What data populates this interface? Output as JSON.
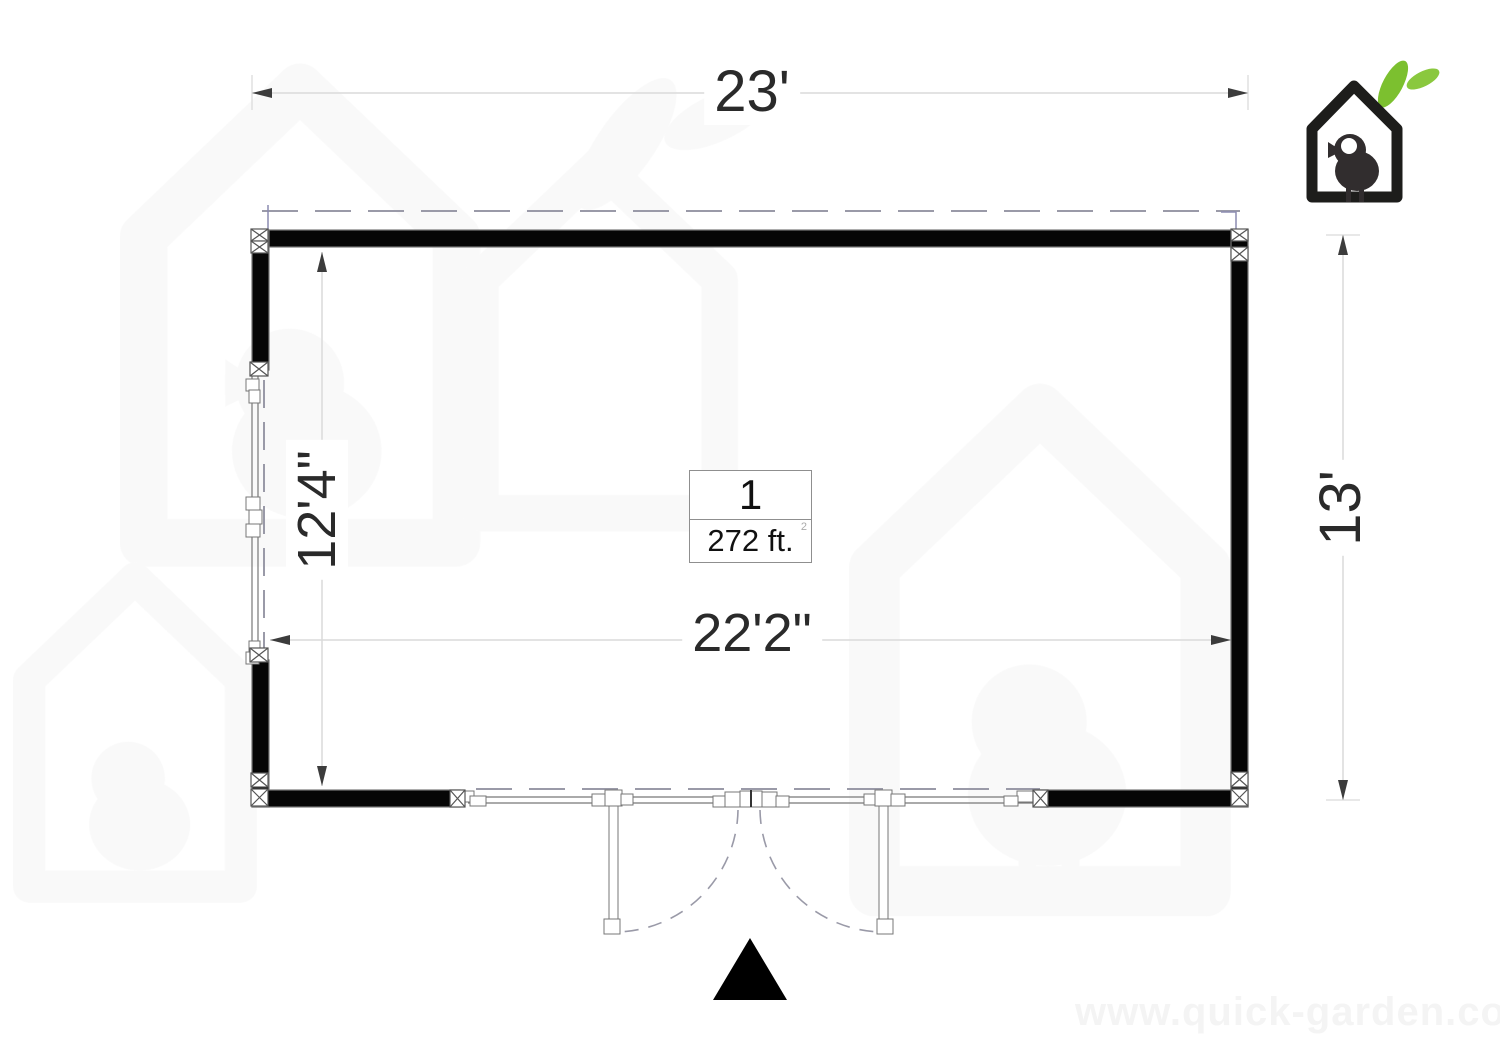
{
  "plan": {
    "dimensions": {
      "overall_width": "23'",
      "overall_depth": "13'",
      "interior_depth": "12'4\"",
      "interior_width": "22'2\""
    },
    "room": {
      "number": "1",
      "area": "272 ft.",
      "area_superscript": "2"
    }
  },
  "watermark": {
    "url_text": "www.quick-garden.co.uk"
  },
  "colors": {
    "wall": "#060606",
    "wall_outline": "#777777",
    "dashed_line": "#9a9aa8",
    "dimension_line": "#dadada",
    "arrow": "#3c3c3c",
    "logo_black": "#1d1d1b",
    "bird": "#312d2e",
    "leaf_green_1": "#7cc02f",
    "leaf_green_2": "#8ac83e",
    "faint_watermark": "#f5f5f5"
  },
  "icons": {
    "logo": "birdhouse-logo",
    "leaves": "leaf-icon",
    "entrance": "entrance-arrow"
  }
}
